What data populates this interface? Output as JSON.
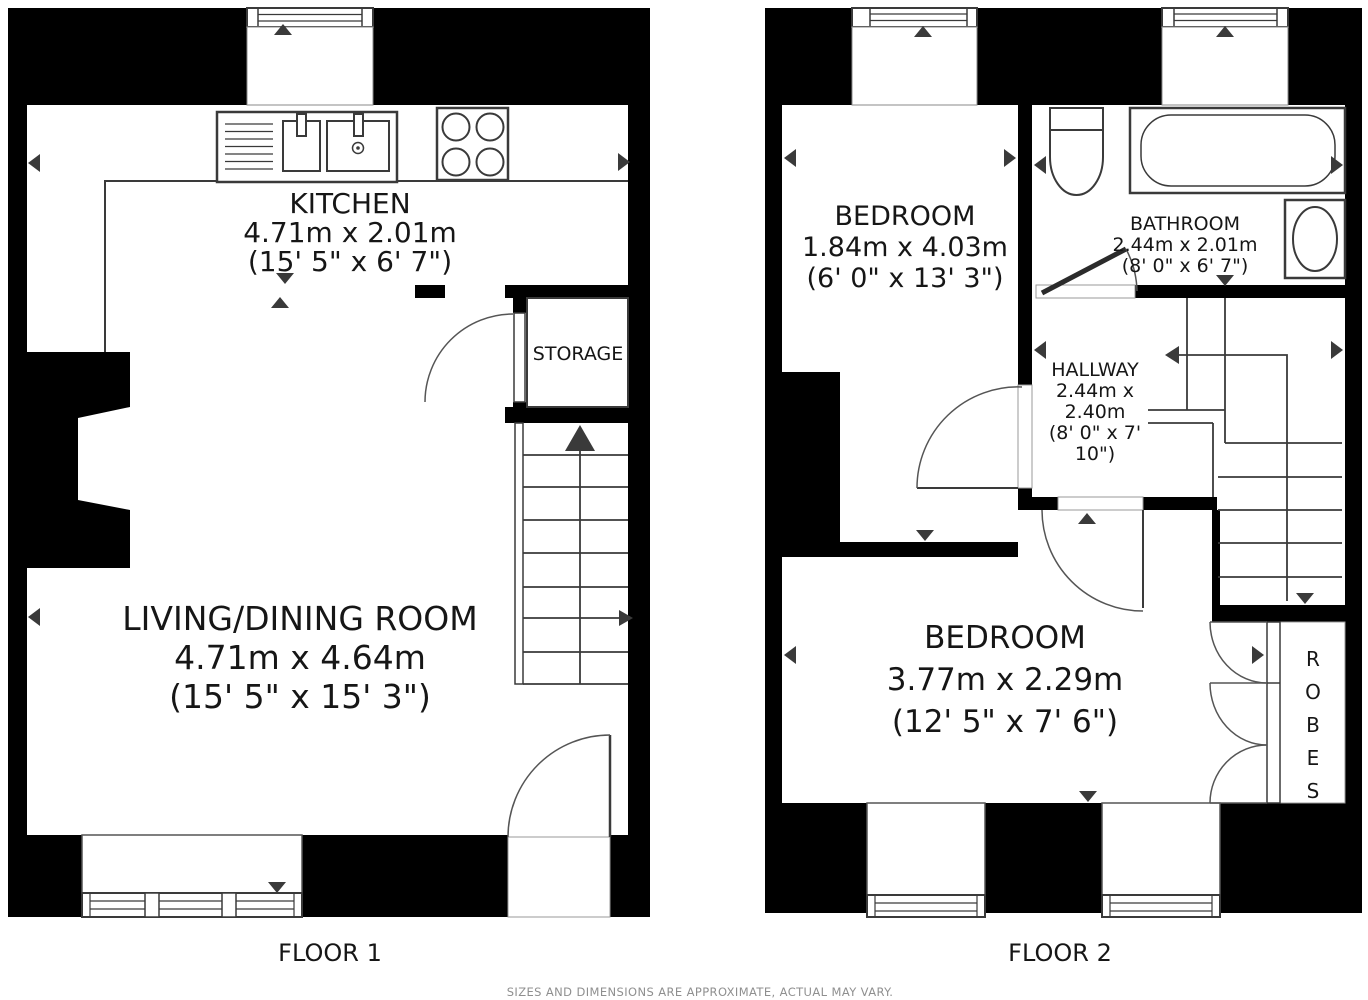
{
  "meta": {
    "type": "property-floorplan",
    "floors": 2
  },
  "colors": {
    "wall": "#000000",
    "line": "#3a3a3a",
    "arc": "#555555",
    "text": "#161616",
    "muted": "#8f8f8f"
  },
  "floor1": {
    "label": "FLOOR 1",
    "rooms": {
      "kitchen": {
        "name": "KITCHEN",
        "metric": "4.71m x 2.01m",
        "imperial": "(15' 5\" x 6' 7\")"
      },
      "living": {
        "name": "LIVING/DINING ROOM",
        "metric": "4.71m x 4.64m",
        "imperial": "(15' 5\" x 15' 3\")"
      },
      "storage": {
        "name": "STORAGE"
      }
    }
  },
  "floor2": {
    "label": "FLOOR 2",
    "rooms": {
      "bedroom1": {
        "name": "BEDROOM",
        "metric": "1.84m x 4.03m",
        "imperial": "(6' 0\" x 13' 3\")"
      },
      "bathroom": {
        "name": "BATHROOM",
        "metric": "2.44m x 2.01m",
        "imperial": "(8' 0\" x 6' 7\")"
      },
      "hallway": {
        "name": "HALLWAY",
        "line2": "2.44m x",
        "line3": "2.40m",
        "line4": "(8' 0\" x 7'",
        "line5": "10\")"
      },
      "bedroom2": {
        "name": "BEDROOM",
        "metric": "3.77m x 2.29m",
        "imperial": "(12' 5\" x 7' 6\")"
      },
      "robes": {
        "name": "ROBES",
        "letters": [
          "R",
          "O",
          "B",
          "E",
          "S"
        ]
      }
    }
  },
  "footer": {
    "disclaimer": "SIZES AND DIMENSIONS ARE APPROXIMATE, ACTUAL MAY VARY."
  }
}
